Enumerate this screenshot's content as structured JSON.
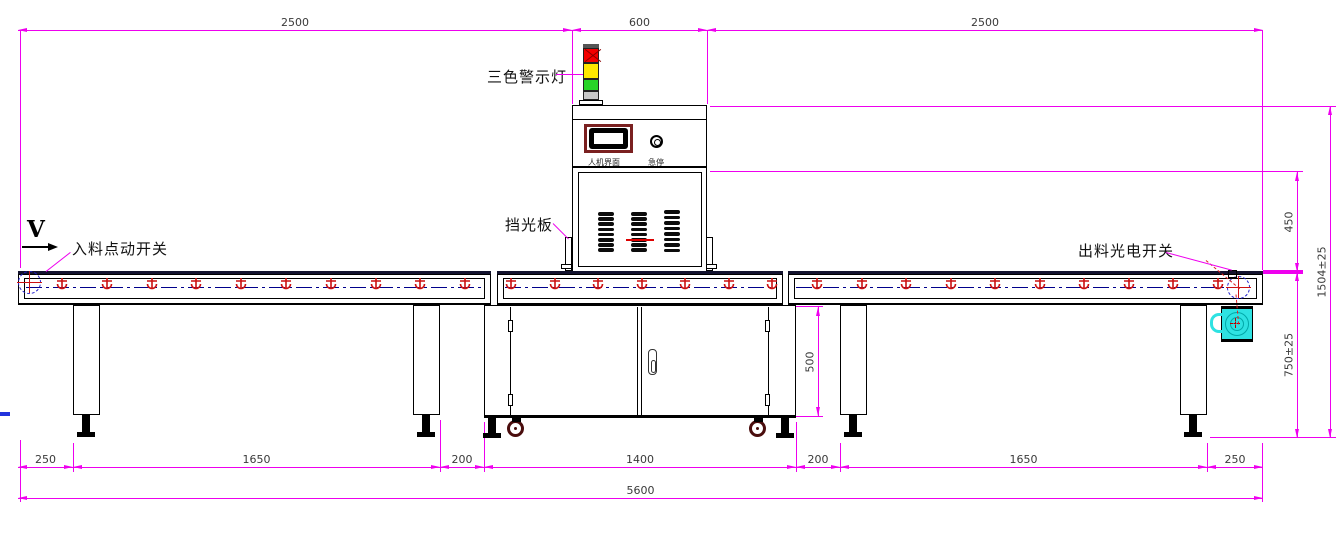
{
  "drawing_title": "conveyor-line-side-view",
  "flow": {
    "symbol": "V"
  },
  "labels": {
    "tower_light": "三色警示灯",
    "light_shield": "挡光板",
    "infeed_switch": "入料点动开关",
    "outfeed_switch": "出料光电开关",
    "hmi": "人机界面",
    "estop": "急停"
  },
  "dims": {
    "top": [
      "2500",
      "600",
      "2500"
    ],
    "bottom": [
      "250",
      "1650",
      "200",
      "1400",
      "200",
      "1650",
      "250"
    ],
    "total": "5600",
    "right": {
      "upper": "450",
      "lower": "750±25",
      "overall": "1504±25"
    },
    "cabinet_height": "500"
  },
  "colors": {
    "dimension": "#ee00ee",
    "outline": "#000000",
    "centerline": "#00008b",
    "belt": "#12122e",
    "roller": "#cc1111",
    "sensor_blue": "#2020cc",
    "motor_cyan": "#2ee2e2",
    "red_dash": "#dd2222",
    "lamp_red": "#f40000",
    "lamp_yellow": "#ffe800",
    "lamp_green": "#28d428",
    "lamp_base": "#c8c8c8",
    "hmi_frame": "#7a2020"
  },
  "rollers": {
    "sections": [
      {
        "start": 62,
        "count": 10,
        "step": 44.8
      },
      {
        "start": 511,
        "count": 7,
        "step": 43.5
      },
      {
        "start": 817,
        "count": 10,
        "step": 44.5
      }
    ]
  },
  "heaters": {
    "bars_per_stack": 8
  }
}
